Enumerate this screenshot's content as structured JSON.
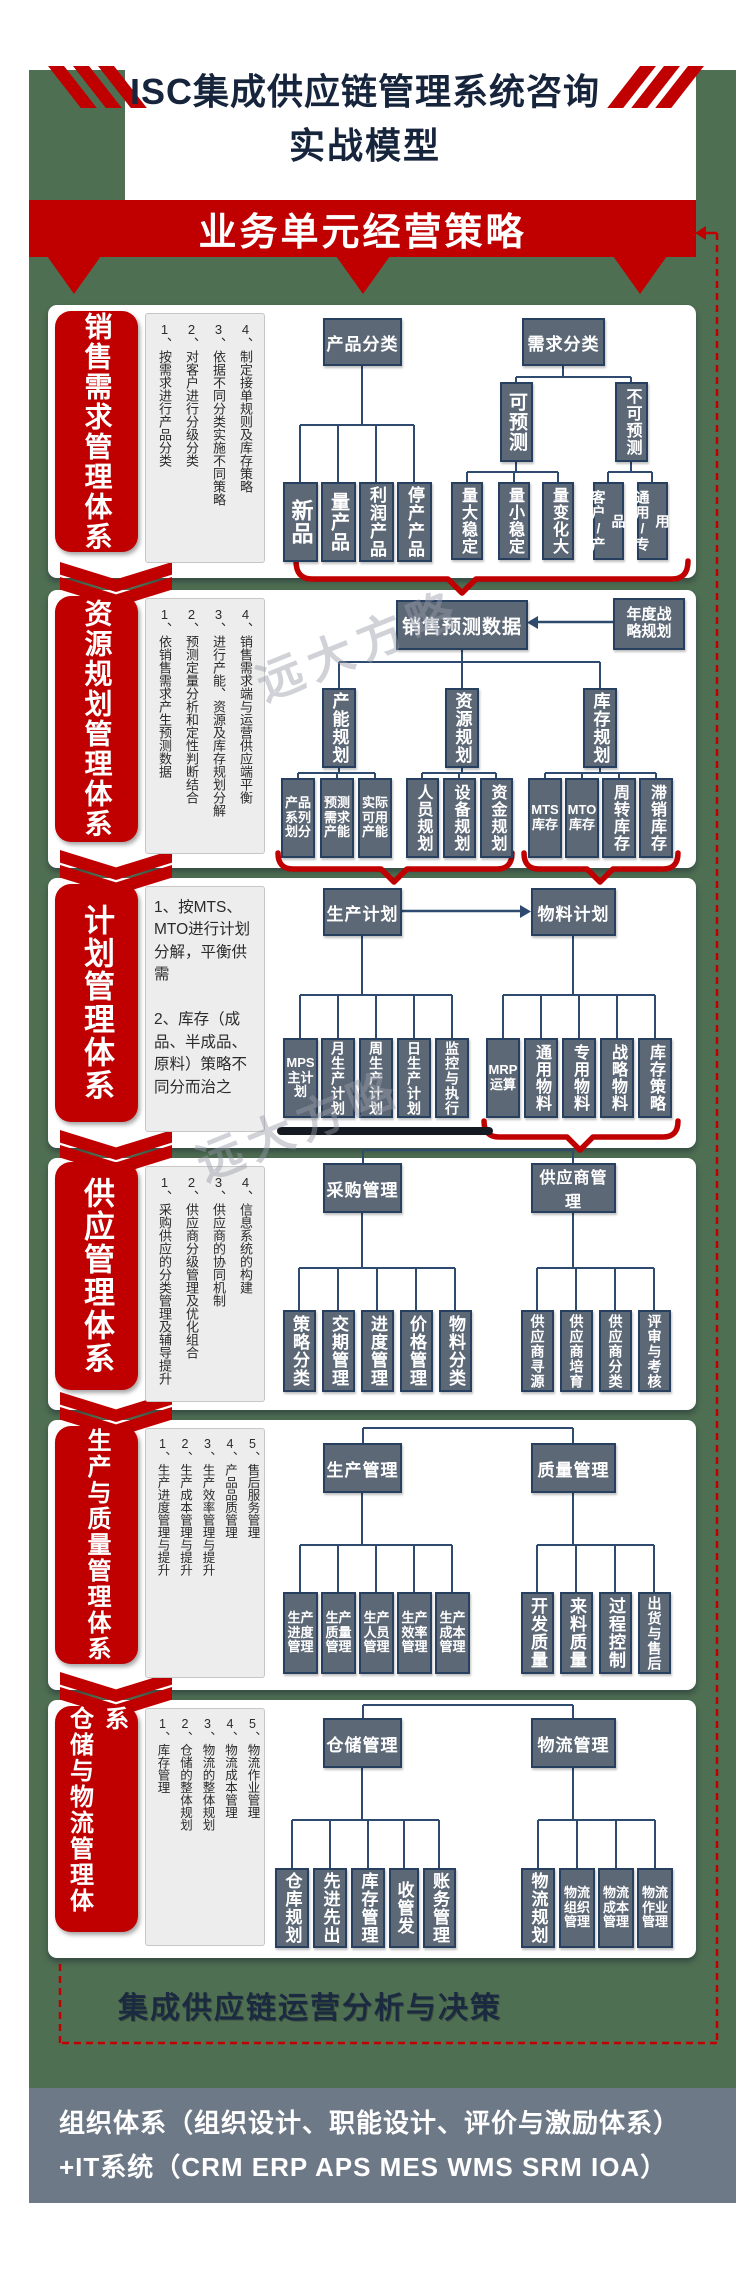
{
  "title": {
    "line1": "ISC集成供应链管理系统咨询",
    "line2": "实战模型"
  },
  "banner": {
    "label": "业务单元经营策略"
  },
  "watermark": {
    "text": "远大方略"
  },
  "decision": {
    "label": "集成供应链运营分析与决策"
  },
  "footer": {
    "line1": "组织体系（组织设计、职能设计、评价与激励体系）",
    "line2": "+IT系统（CRM ERP APS MES WMS SRM IOA）"
  },
  "colors": {
    "accent_red": "#c00000",
    "canvas_green": "#4f6f52",
    "node_slate": "#5d6877",
    "node_border": "#27405f",
    "footer_gray": "#6e7987",
    "title_navy": "#16243c"
  },
  "sections": [
    {
      "pill": "销售需求管理体系",
      "notes": [
        "1、按需求进行产品分类",
        "2、对客户进行分级分类",
        "3、依据不同分类实施不同策略",
        "4、制定接单规则及库存策略"
      ],
      "h1": "产品分类",
      "h2": "需求分类",
      "a": [
        "新品",
        "量产品",
        "利润产品",
        "停产产品"
      ],
      "mid": [
        "可预测",
        "不可预测"
      ],
      "b1": [
        "量大稳定",
        "量小稳定",
        "量变化大"
      ],
      "b2": [
        "客户/产品",
        "通用/专用"
      ]
    },
    {
      "pill": "资源规划管理体系",
      "notes": [
        "1、依销售需求产生预测数据",
        "2、预测定量分析和定性判断结合",
        "3、进行产能、资源及库存规划分解",
        "4、销售需求端与运营供应端平衡"
      ],
      "root": "销售预测数据",
      "side": "年度战\n略规划",
      "mids": [
        "产能规划",
        "资源规划",
        "库存规划"
      ],
      "a": [
        "产品\n系列\n划分",
        "预测\n需求\n产能",
        "实际\n可用\n产能"
      ],
      "b": [
        "人员规划",
        "设备规划",
        "资金规划"
      ],
      "c": [
        "MTS\n库存",
        "MTO\n库存",
        "周转库存",
        "滞销库存"
      ]
    },
    {
      "pill": "计划管理体系",
      "notes_text": "1、按MTS、MTO进行计划分解，平衡供需\n\n2、库存（成品、半成品、原料）策略不同分而治之",
      "h1": "生产计划",
      "h2": "物料计划",
      "a": [
        "MPS\n主计\n划",
        "月生产计划",
        "周生产计划",
        "日生产计划",
        "监控与执行"
      ],
      "b": [
        "MRP\n运算",
        "通用物料",
        "专用物料",
        "战略物料",
        "库存策略"
      ]
    },
    {
      "pill": "供应管理体系",
      "notes": [
        "1、采购供应的分类管理及辅导提升",
        "2、供应商分级管理及优化组合",
        "3、供应商的协同机制",
        "4、信息系统的构建"
      ],
      "h1": "采购管理",
      "h2": "供应商管理",
      "a": [
        "策略分类",
        "交期管理",
        "进度管理",
        "价格管理",
        "物料分类"
      ],
      "b": [
        "供应商寻源",
        "供应商培育",
        "供应商分类",
        "评审与考核"
      ]
    },
    {
      "pill": "生产与质量管理体系",
      "notes": [
        "1、生产进度管理与提升",
        "2、生产成本管理与提升",
        "3、生产效率管理与提升",
        "4、产品品质管理",
        "5、售后服务管理"
      ],
      "h1": "生产管理",
      "h2": "质量管理",
      "a": [
        "生产\n进度\n管理",
        "生产\n质量\n管理",
        "生产\n人员\n管理",
        "生产\n效率\n管理",
        "生产\n成本\n管理"
      ],
      "b": [
        "开发质量",
        "来料质量",
        "过程控制",
        "出货与售后"
      ]
    },
    {
      "pill": "仓储与物流管理体系",
      "notes": [
        "1、库存管理",
        "2、仓储的整体规划",
        "3、物流的整体规划",
        "4、物流成本管理",
        "5、物流作业管理"
      ],
      "h1": "仓储管理",
      "h2": "物流管理",
      "a": [
        "仓库规划",
        "先进先出",
        "库存管理",
        "收管发",
        "账务管理"
      ],
      "b": [
        "物流规划",
        "物流\n组织\n管理",
        "物流\n成本\n管理",
        "物流\n作业\n管理"
      ]
    }
  ]
}
